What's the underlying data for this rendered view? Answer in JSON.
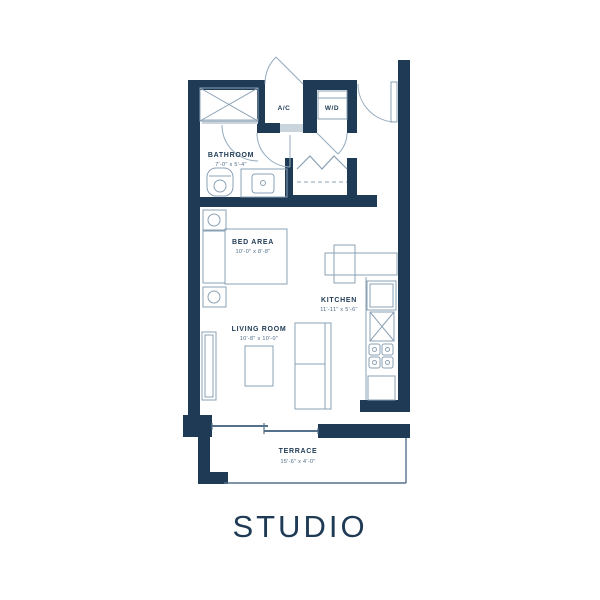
{
  "title": "STUDIO",
  "colors": {
    "wall": "#1e3a54",
    "line": "#8aa0b4",
    "arc": "#93a9bc",
    "mid": "#55718b",
    "dim": "#4e6a84",
    "threshold": "#c9d4dd"
  },
  "rooms": {
    "bathroom": {
      "label": "BATHROOM",
      "dims": "7'-0\" x 5'-4\""
    },
    "bed_area": {
      "label": "BED AREA",
      "dims": "10'-0\" x 8'-8\""
    },
    "living_room": {
      "label": "LIVING ROOM",
      "dims": "10'-8\" x 10'-0\""
    },
    "kitchen": {
      "label": "KITCHEN",
      "dims": "11'-11\" x 5'-6\""
    },
    "terrace": {
      "label": "TERRACE",
      "dims": "15'-6\" x 4'-0\""
    },
    "ac_closet": {
      "label": "A/C"
    },
    "laundry_closet": {
      "label": "W/D"
    }
  }
}
